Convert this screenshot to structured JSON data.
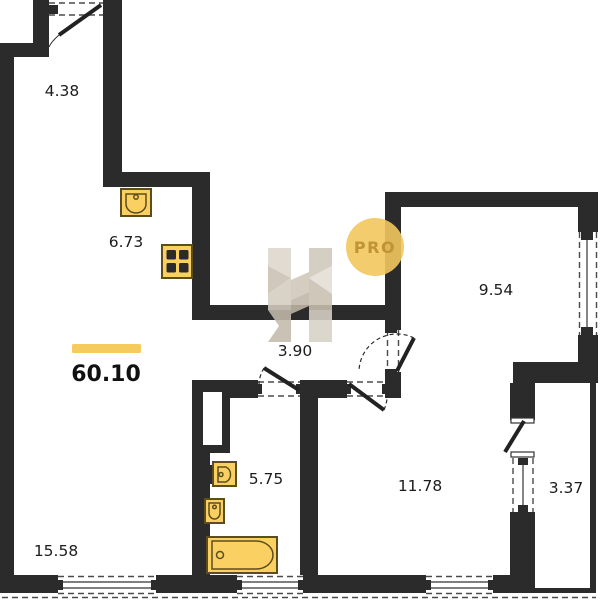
{
  "plan": {
    "total_area": "60.10",
    "badge_label": "PRO",
    "rooms": [
      {
        "name": "hallway",
        "area": "4.38"
      },
      {
        "name": "kitchen",
        "area": "6.73"
      },
      {
        "name": "corridor",
        "area": "3.90"
      },
      {
        "name": "bedroom-small",
        "area": "9.54"
      },
      {
        "name": "bathroom",
        "area": "5.75"
      },
      {
        "name": "bedroom",
        "area": "11.78"
      },
      {
        "name": "balcony",
        "area": "3.37"
      },
      {
        "name": "living-room",
        "area": "15.58"
      }
    ],
    "colors": {
      "wall": "#2b2b2b",
      "fixture_fill": "#fbd063",
      "fixture_stroke": "#5c4d1e",
      "accent_bar": "#f6cb5d",
      "badge_bg": "#f2c75e",
      "badge_text": "#bf9336",
      "watermark": "#d2cabd"
    }
  }
}
